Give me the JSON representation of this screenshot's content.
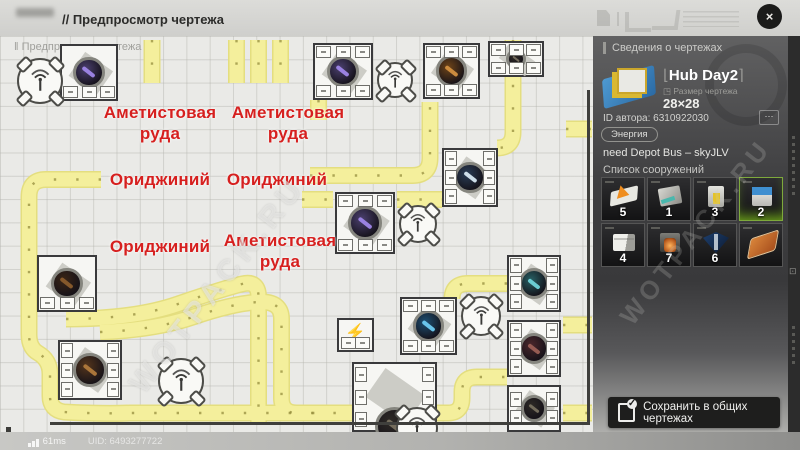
{
  "colors": {
    "accent_red": "#d6201f",
    "belt_fill": "#f4ef9c",
    "belt_edge": "#e4de7f",
    "belt_dots": "#958e3e",
    "panel_selected_glow": "#7ec818",
    "save_button_bg": "#1e1e1d"
  },
  "top_bar": {
    "title": "// Предпросмотр чертежа",
    "close_glyph": "×"
  },
  "status_bar": {
    "ping": "61ms",
    "uid": "UID: 6493277722"
  },
  "map": {
    "overlay_label": "‖ Предпросмотр чертежа",
    "watermark": "WOTPACK.RU",
    "labels": [
      {
        "lines": [
          "Аметистовая",
          "руда"
        ],
        "cx": 160,
        "top": 66
      },
      {
        "lines": [
          "Аметистовая",
          "руда"
        ],
        "cx": 288,
        "top": 66
      },
      {
        "lines": [
          "Ориджиний"
        ],
        "cx": 160,
        "top": 133
      },
      {
        "lines": [
          "Ориджиний"
        ],
        "cx": 277,
        "top": 133
      },
      {
        "lines": [
          "Ориджиний"
        ],
        "cx": 160,
        "top": 200
      },
      {
        "lines": [
          "Аметистовая",
          "руда"
        ],
        "cx": 280,
        "top": 194
      }
    ],
    "belts": [
      "M152 4 V47",
      "M236.5 4 V47",
      "M258.5 4 V47",
      "M280.5 4 V47",
      "M513 4 V96 Q513 112 497 112",
      "M318.5 64 V84",
      "M101 143.5 H46 Q29 143.5 29 161 V298 Q29 312 38 317 Q50 324 50 338 V360 Q50 374 64 376 Q100 378 130 377 H352",
      "M310 139.5 H412 Q430 139.5 430 122 V66",
      "M302 163.5 H333",
      "M397 163.5 H442",
      "M507 247.5 H468 Q452 247.5 452 263",
      "M66 283 Q135 283 178 268 Q225 252 242 248 Q258.5 244 258.5 261 V387",
      "M100 296 Q155 294 193 281 Q237 266 262 266 Q281.5 266 281.5 283 V362 Q281.5 377 297 377 H315",
      "M437 377 H448 Q462 377 462 362 V356 Q462 341 477 341 H507",
      "M563 289 H592",
      "M563 377 H592",
      "M566 93 H592"
    ],
    "core_colors": {
      "purple": [
        "#4a3f6e",
        "#9f86e8"
      ],
      "orange": [
        "#6e4418",
        "#d29040"
      ],
      "navy": [
        "#2a3d56",
        "#d8e8f2"
      ],
      "blue": [
        "#1d4f73",
        "#6ecbf2"
      ],
      "teal": [
        "#275f63",
        "#6fd3d8"
      ],
      "maroon": [
        "#4a272b",
        "#9b5f55"
      ],
      "brown": [
        "#54351c",
        "#b07a3c"
      ],
      "darkbrown": [
        "#3a2516",
        "#8a5c2c"
      ],
      "dark": [
        "#2e2a26",
        "#77705f"
      ]
    },
    "machines": [
      {
        "x": 60,
        "y": 8,
        "w": 58,
        "h": 57,
        "core": "purple",
        "ports": [
          "bottom"
        ]
      },
      {
        "x": 313,
        "y": 7,
        "w": 60,
        "h": 57,
        "core": "purple",
        "ports": [
          "top",
          "bottom"
        ]
      },
      {
        "x": 423,
        "y": 7,
        "w": 57,
        "h": 56,
        "core": "orange",
        "ports": [
          "top",
          "bottom"
        ]
      },
      {
        "x": 488,
        "y": 5,
        "w": 56,
        "h": 36,
        "core": "dark",
        "ports": [
          "top",
          "bottom"
        ]
      },
      {
        "x": 442,
        "y": 112,
        "w": 56,
        "h": 59,
        "core": "navy",
        "ports": [
          "left",
          "right"
        ]
      },
      {
        "x": 335,
        "y": 156,
        "w": 60,
        "h": 62,
        "core": "purple",
        "ports": [
          "top",
          "bottom"
        ]
      },
      {
        "x": 37,
        "y": 219,
        "w": 60,
        "h": 57,
        "core": "darkbrown",
        "ports": [
          "bottom"
        ]
      },
      {
        "x": 58,
        "y": 304,
        "w": 64,
        "h": 60,
        "core": "brown",
        "ports": [
          "left",
          "right"
        ]
      },
      {
        "x": 337,
        "y": 282,
        "w": 37,
        "h": 34,
        "type": "power",
        "ports": [
          "bottom2"
        ]
      },
      {
        "x": 400,
        "y": 261,
        "w": 57,
        "h": 58,
        "core": "blue",
        "ports": [
          "top",
          "bottom"
        ]
      },
      {
        "x": 507,
        "y": 219,
        "w": 54,
        "h": 57,
        "core": "teal",
        "ports": [
          "left",
          "right"
        ]
      },
      {
        "x": 507,
        "y": 284,
        "w": 54,
        "h": 57,
        "core": "maroon",
        "ports": [
          "left",
          "right"
        ]
      },
      {
        "x": 507,
        "y": 349,
        "w": 54,
        "h": 47,
        "core": "dark",
        "ports": [
          "left",
          "right"
        ]
      },
      {
        "x": 352,
        "y": 326,
        "w": 85,
        "h": 70,
        "core": "dark",
        "core_pos": [
          0.5,
          0.92
        ],
        "ports": [
          "left",
          "right"
        ]
      }
    ],
    "towers": [
      {
        "cx": 40,
        "cy": 45,
        "d": 46
      },
      {
        "cx": 395,
        "cy": 44,
        "d": 36
      },
      {
        "cx": 418,
        "cy": 188,
        "d": 38
      },
      {
        "cx": 481,
        "cy": 280,
        "d": 40
      },
      {
        "cx": 181,
        "cy": 345,
        "d": 46
      },
      {
        "cx": 417,
        "cy": 392,
        "d": 42
      }
    ]
  },
  "panel": {
    "header": "Сведения о чертежах",
    "blueprint": {
      "bracket_l": "⌊",
      "name": "Hub Day2",
      "bracket_r": "⌉",
      "size_icon": "◳",
      "size_label": "Размер чертежа",
      "size": "28×28"
    },
    "author": "ID автора: 6310922030",
    "more_glyph": "⋯",
    "tag": "Энергия",
    "note": "need Depot Bus – skyJLV",
    "list_title": "Список сооружений",
    "tiles": [
      {
        "icon": "conveyor",
        "count": "5"
      },
      {
        "icon": "crusher",
        "count": "1"
      },
      {
        "icon": "powerplant",
        "count": "3"
      },
      {
        "icon": "hub",
        "count": "2",
        "selected": true
      },
      {
        "icon": "depot",
        "count": "4"
      },
      {
        "icon": "furnace",
        "count": "7"
      },
      {
        "icon": "pylon",
        "count": "6"
      },
      {
        "icon": "foundation",
        "count": ""
      }
    ],
    "save_label": "Сохранить в общих чертежах",
    "rail_icon": "⊡"
  }
}
